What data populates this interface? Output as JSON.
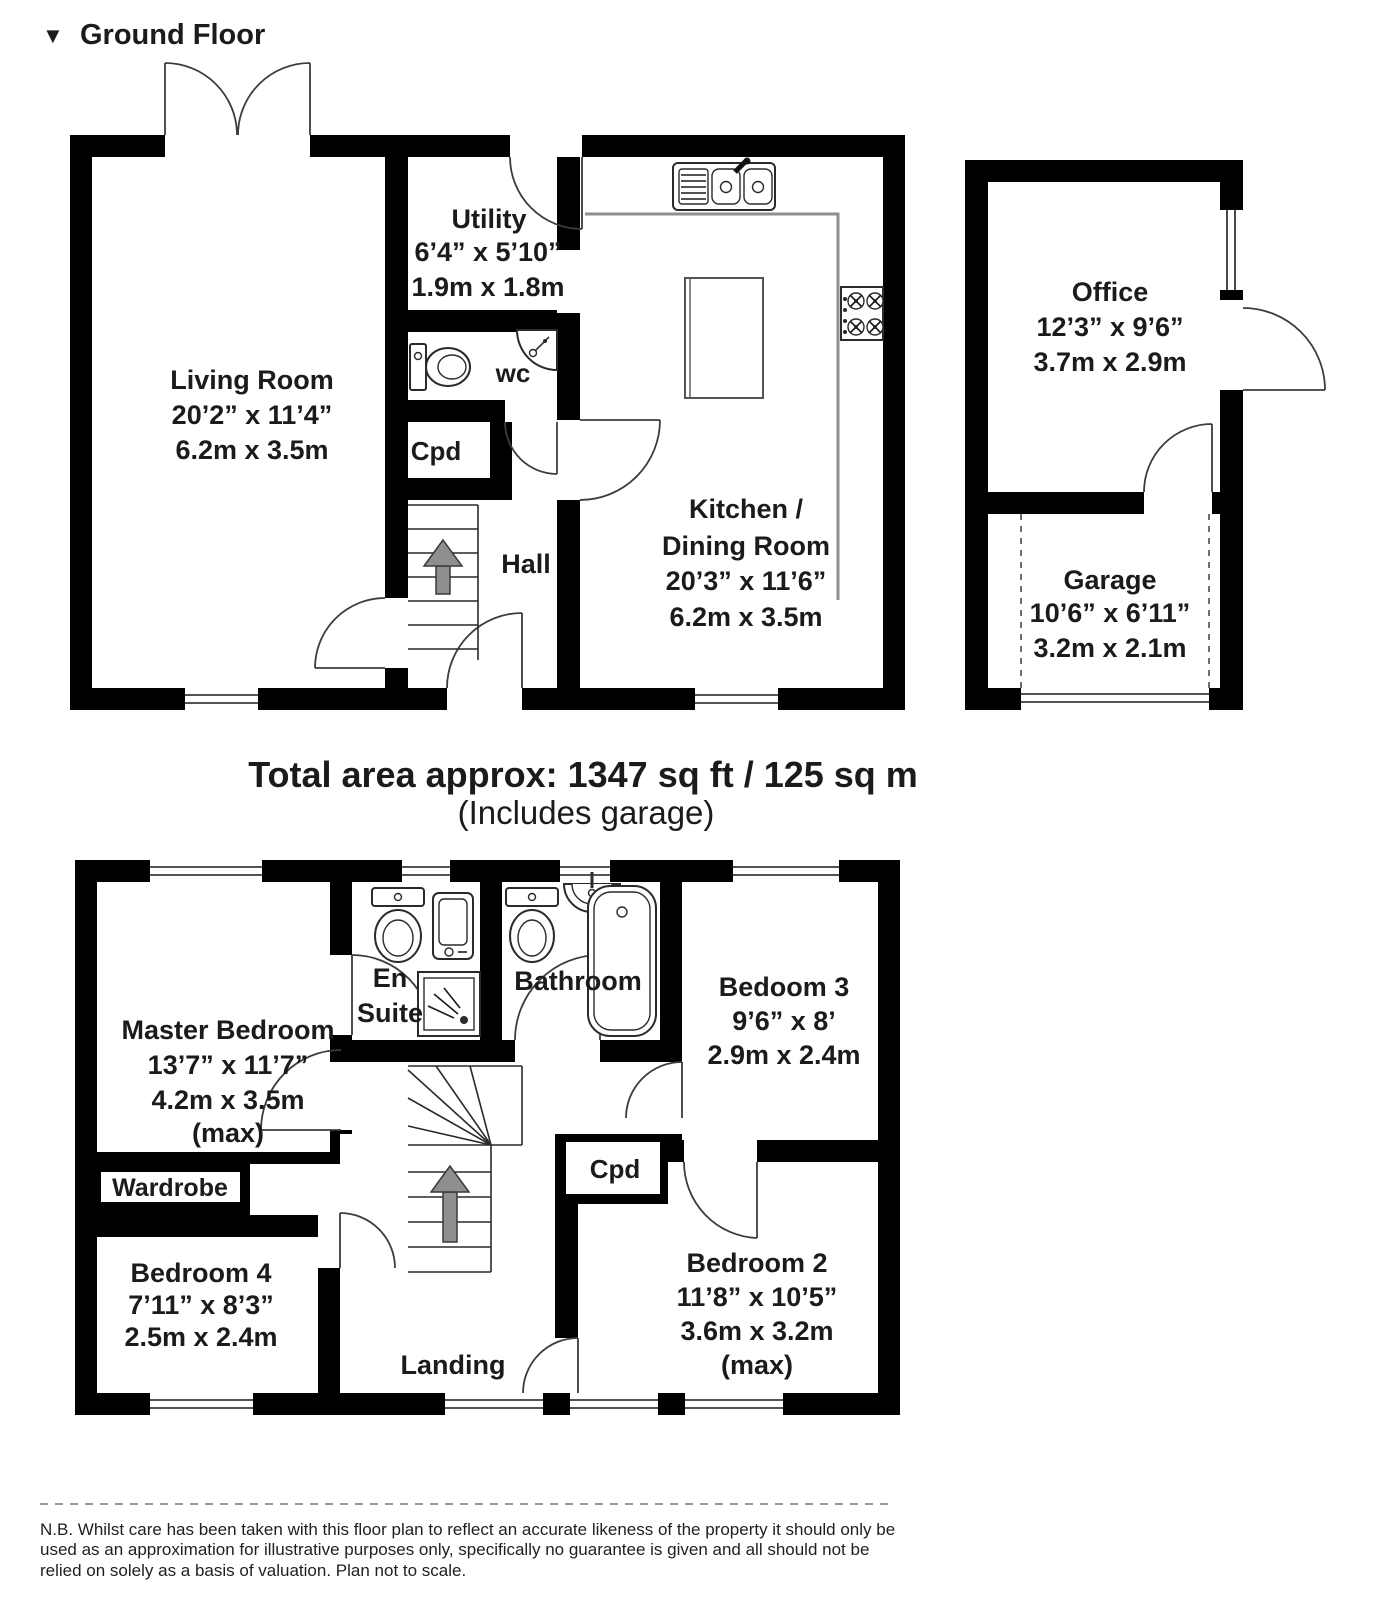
{
  "page": {
    "marker": "▼",
    "title": "Ground Floor"
  },
  "colors": {
    "wall": "#000000",
    "floor": "#ffffff",
    "text": "#1b1b1b",
    "arrow_fill": "#8f8f8f",
    "counter": "#8f8f8f"
  },
  "ground_floor": {
    "living_room": {
      "name": "Living Room",
      "imperial": "20’2” x 11’4”",
      "metric": "6.2m x 3.5m"
    },
    "utility": {
      "name": "Utility",
      "imperial": "6’4” x 5’10”",
      "metric": "1.9m x 1.8m"
    },
    "wc": {
      "name": "wc"
    },
    "cpd": {
      "name": "Cpd"
    },
    "hall": {
      "name": "Hall"
    },
    "kitchen_dining": {
      "name_line1": "Kitchen /",
      "name_line2": "Dining Room",
      "imperial": "20’3” x 11’6”",
      "metric": "6.2m x 3.5m"
    },
    "office": {
      "name": "Office",
      "imperial": "12’3” x 9’6”",
      "metric": "3.7m x 2.9m"
    },
    "garage": {
      "name": "Garage",
      "imperial": "10’6” x 6’11”",
      "metric": "3.2m x 2.1m"
    }
  },
  "area_summary": {
    "line1": "Total area approx: 1347 sq ft / 125 sq m",
    "line2": "(Includes garage)"
  },
  "first_floor": {
    "master_bedroom": {
      "name": "Master Bedroom",
      "imperial": "13’7” x 11’7”",
      "metric": "4.2m x 3.5m",
      "qualifier": "(max)"
    },
    "en_suite": {
      "name_line1": "En",
      "name_line2": "Suite"
    },
    "bathroom": {
      "name": "Bathroom"
    },
    "bedroom3": {
      "name": "Bedoom 3",
      "imperial": "9’6” x 8’",
      "metric": "2.9m x 2.4m"
    },
    "wardrobe": {
      "name": "Wardrobe"
    },
    "bedroom4": {
      "name": "Bedroom 4",
      "imperial": "7’11” x 8’3”",
      "metric": "2.5m x 2.4m"
    },
    "cpd": {
      "name": "Cpd"
    },
    "bedroom2": {
      "name": "Bedroom 2",
      "imperial": "11’8” x 10’5”",
      "metric": "3.6m x 3.2m",
      "qualifier": "(max)"
    },
    "landing": {
      "name": "Landing"
    }
  },
  "disclaimer": {
    "text": "N.B. Whilst care has been taken with this floor plan to reflect an accurate likeness of the property it should only be used as an approximation for illustrative purposes only, specifically no guarantee is given and all should not be relied on solely as a basis of valuation. Plan not to scale."
  }
}
